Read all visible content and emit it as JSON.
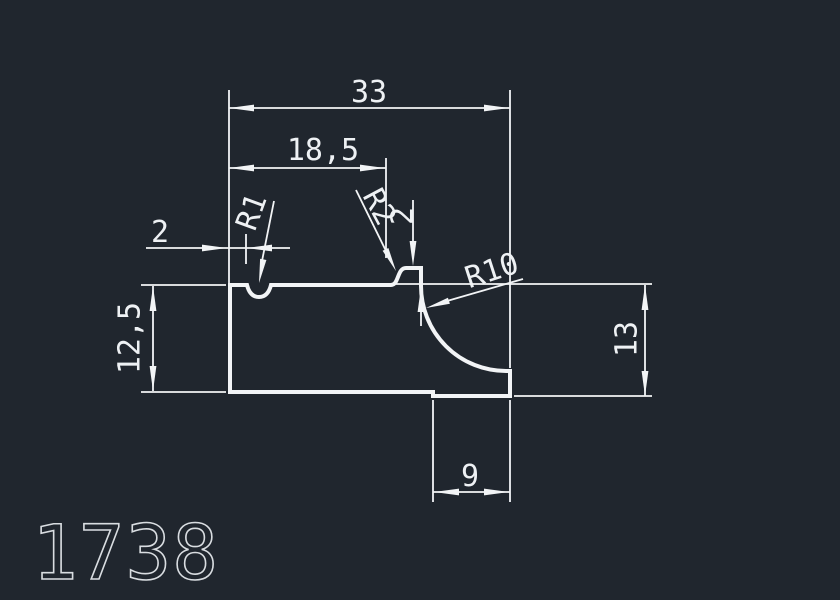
{
  "drawing": {
    "part_number": "1738",
    "colors": {
      "background": "#20262e",
      "line": "#f2f4f6",
      "part_number_stroke": "#d9dde1"
    },
    "dimensions": {
      "overall_width": "33",
      "upper_width": "18,5",
      "groove_offset": "2",
      "left_height": "12,5",
      "right_height": "13",
      "foot_width": "9",
      "step_height": "2"
    },
    "radii": {
      "groove": "R1",
      "step_fillet": "R2",
      "cove": "R10"
    }
  }
}
